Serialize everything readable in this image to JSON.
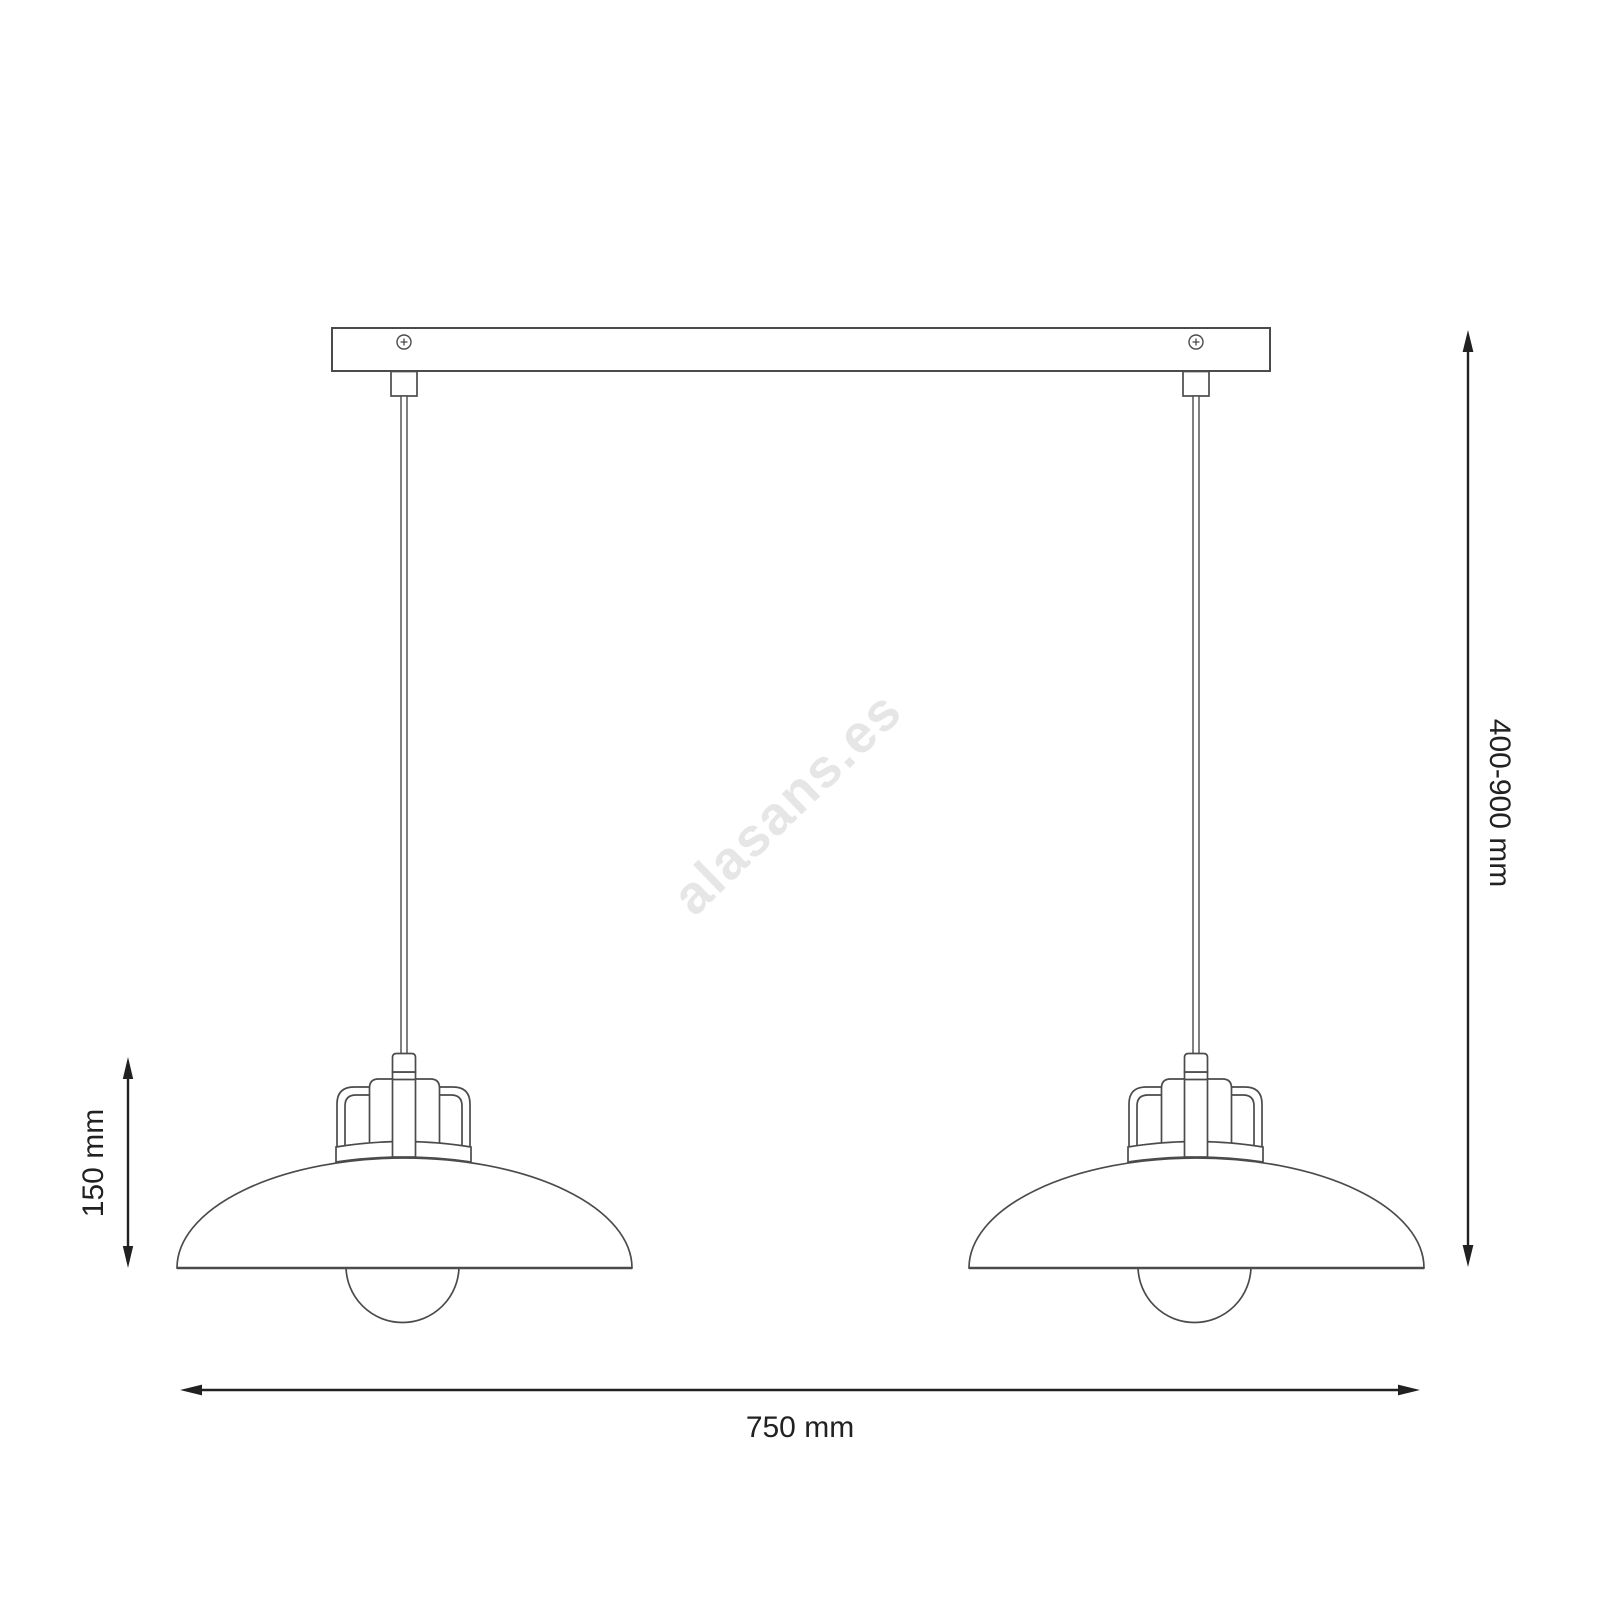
{
  "diagram": {
    "watermark": "alasans.es",
    "labels": {
      "drop_height": "400-900 mm",
      "shade_height": "150 mm",
      "width": "750 mm"
    },
    "colors": {
      "line": "#4b4b4b",
      "dimension": "#212121",
      "watermark": "#e6e6e6",
      "background": "#ffffff"
    }
  }
}
